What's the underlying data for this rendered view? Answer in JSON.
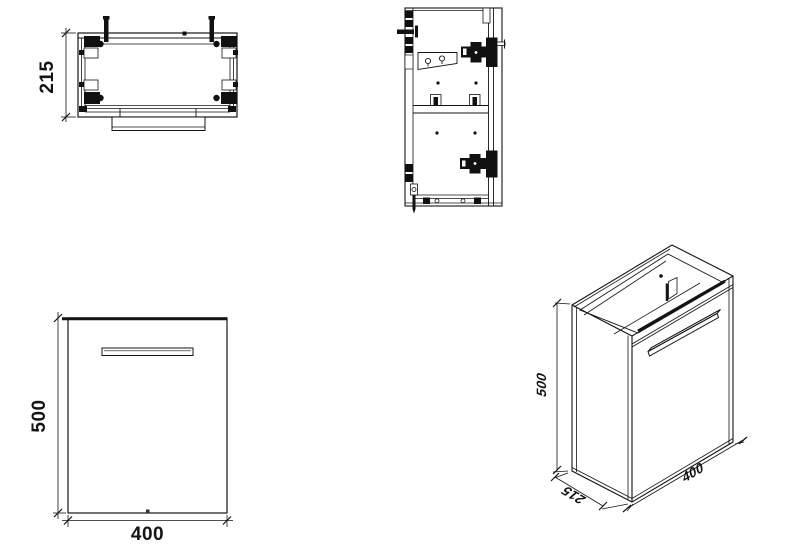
{
  "drawing": {
    "line_color": "#141414",
    "background": "#ffffff",
    "views": {
      "top_view": {
        "dim_depth": "215"
      },
      "front_view": {
        "dim_height": "500",
        "dim_width": "400"
      },
      "iso_view": {
        "dim_height": "500",
        "dim_depth": "215",
        "dim_width": "400"
      }
    }
  }
}
